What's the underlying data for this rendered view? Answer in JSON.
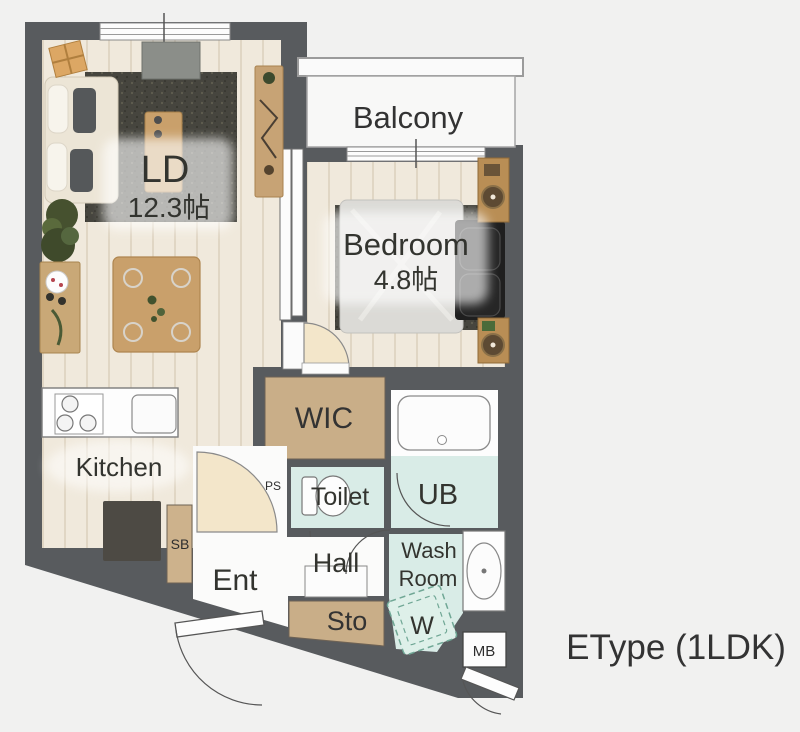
{
  "plan": {
    "type_label": "EType (1LDK)",
    "rooms": {
      "ld": {
        "name": "LD",
        "size": "12.3帖"
      },
      "bedroom": {
        "name": "Bedroom",
        "size": "4.8帖"
      },
      "balcony": {
        "name": "Balcony"
      },
      "kitchen": {
        "name": "Kitchen"
      },
      "wic": {
        "name": "WIC"
      },
      "toilet": {
        "name": "Toilet"
      },
      "ub": {
        "name": "UB"
      },
      "washroom": {
        "line1": "Wash",
        "line2": "Room"
      },
      "hall": {
        "name": "Hall"
      },
      "entrance": {
        "name": "Ent"
      },
      "storage": {
        "name": "Sto"
      },
      "washer": {
        "name": "W"
      },
      "shoe_box": {
        "name": "SB"
      },
      "pipe_space": {
        "name": "PS"
      },
      "meter_box": {
        "name": "MB"
      }
    },
    "colors": {
      "wall": "#585b5e",
      "floor": "#f0e9dc",
      "mint": "#d9ece7",
      "beige": "#c9ae88",
      "door": "#f3e6ca",
      "background": "#f1f1f0"
    }
  }
}
